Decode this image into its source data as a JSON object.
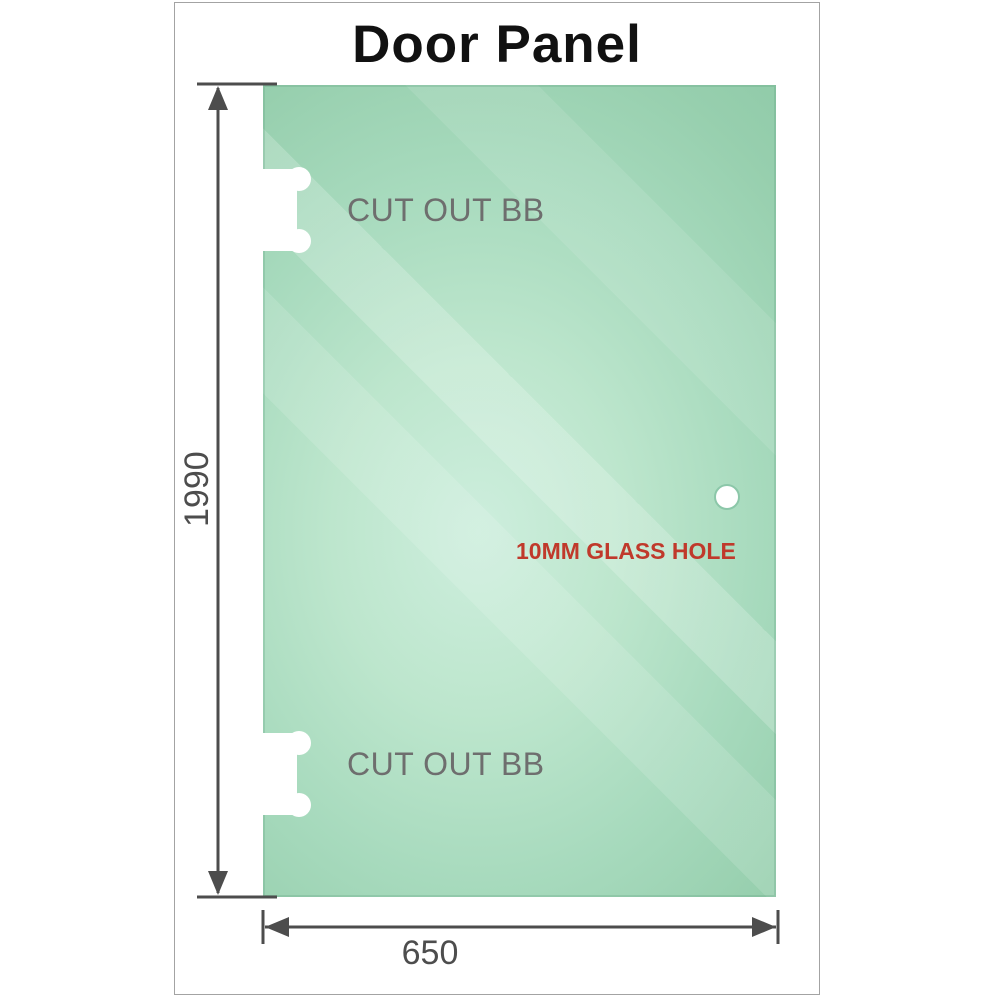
{
  "title": "Door Panel",
  "glass": {
    "cutout_top_label": "CUT OUT BB",
    "cutout_bottom_label": "CUT OUT BB",
    "hole_label": "10MM GLASS HOLE"
  },
  "dimensions": {
    "height": "1990",
    "width": "650"
  },
  "colors": {
    "glass_green_dark": "#8fcaa8",
    "glass_green_light": "#cdeedd",
    "dimension_gray": "#4d4d4d",
    "cutout_label_gray": "#6e6e6e",
    "hole_label_red": "#c0392b",
    "frame_border_gray": "#a3a3a3"
  }
}
